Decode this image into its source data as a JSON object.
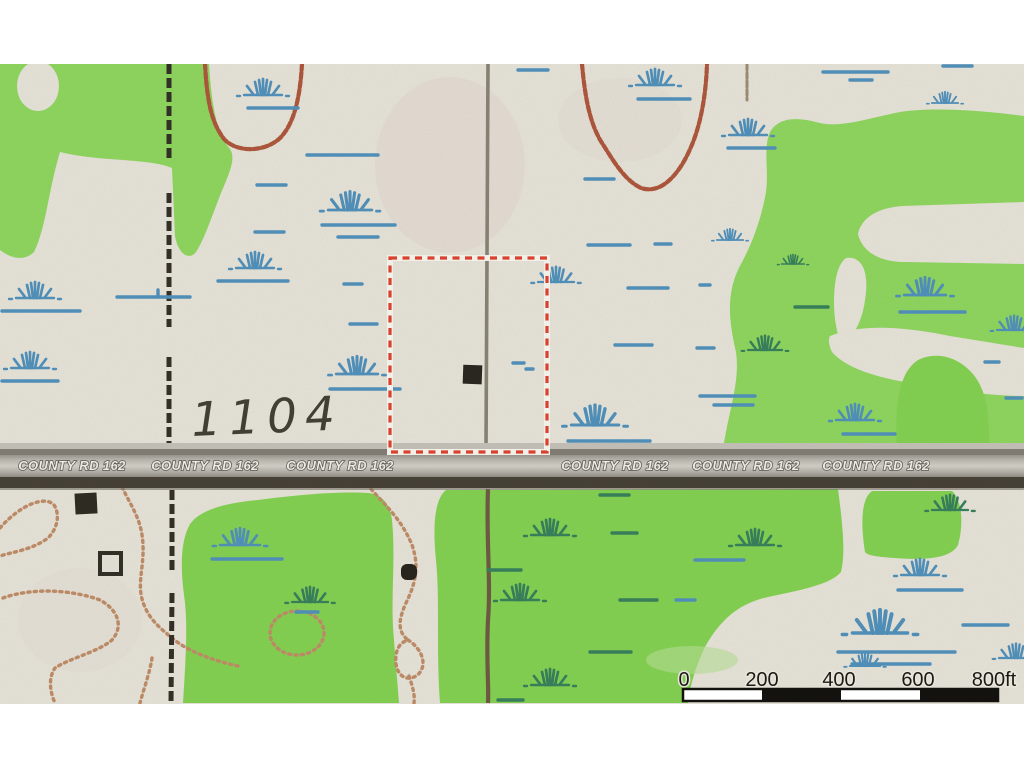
{
  "map": {
    "description": "Scanned USGS-style topographic map excerpt with a parcel highlighted by a red dashed square along a county road",
    "elevation_label": "1104",
    "road": {
      "label": "COUNTY RD 162",
      "repetitions": 6,
      "orientation": "horizontal"
    },
    "parcel_boundary": {
      "shape": "red dashed square",
      "color": "#e23a28"
    },
    "scale_bar": {
      "labels": [
        "0",
        "200",
        "400",
        "600",
        "800ft"
      ],
      "unit": "ft",
      "style": "alternating black and white segments"
    },
    "buildings": [
      {
        "type": "filled-square",
        "location": "inside red parcel boundary"
      },
      {
        "type": "filled-square",
        "location": "southwest quadrant below road"
      },
      {
        "type": "open-square",
        "location": "below the filled square, southwest quadrant"
      },
      {
        "type": "filled-dot",
        "location": "south of road near center"
      }
    ],
    "symbols": {
      "marsh_symbol": "marsh-grass-tuft",
      "section_line": "dashed-black-vertical-line",
      "contour_line": "dotted-brown-line"
    },
    "colors": {
      "vegetation_green": "#8cd95b",
      "background_cream": "#eae7dd",
      "marsh_blue": "#4a8fbe",
      "marsh_teal": "#2f7d58",
      "contour_brown": "#ad5136",
      "contour_tan": "#c08a64",
      "road_gray": "#c9c6bf",
      "road_dark_edge": "#3f3a30",
      "parcel_red": "#e23a28",
      "section_line_black": "#2b2720",
      "margin_white": "#ffffff"
    }
  }
}
